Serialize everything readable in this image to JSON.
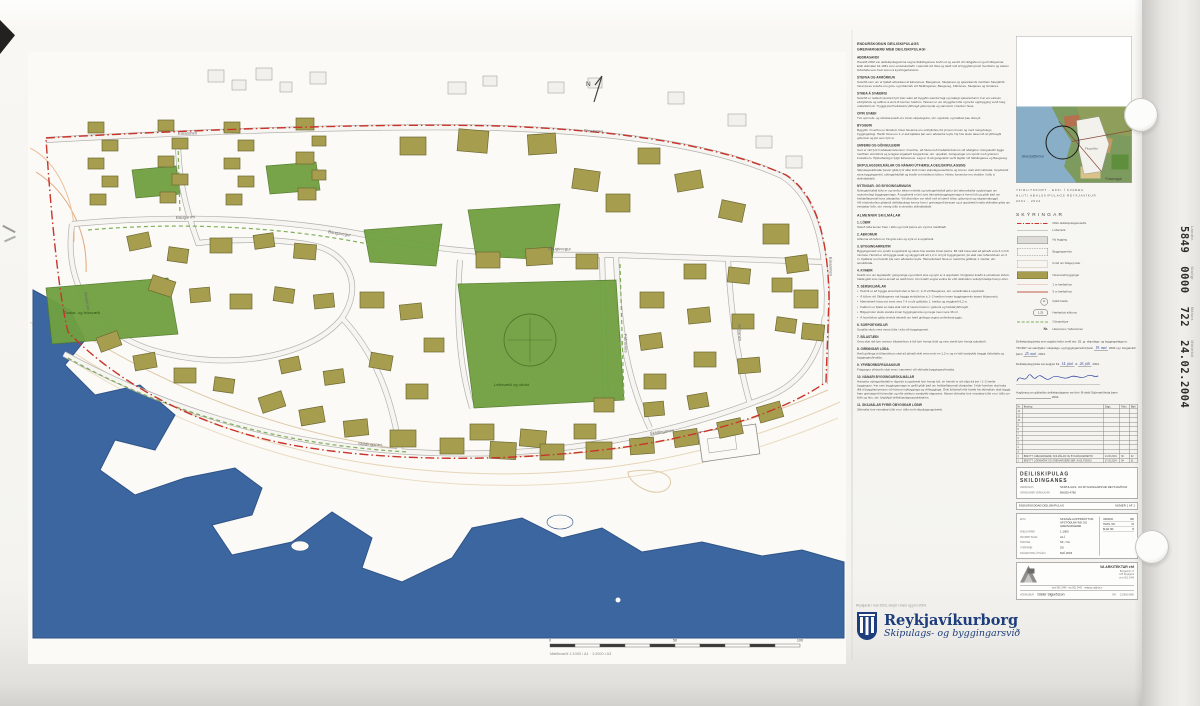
{
  "sheet": {
    "stamp": {
      "items": [
        {
          "label": "Landnr.",
          "value": "5849"
        },
        {
          "label": "Staðgr.",
          "value": "0000"
        },
        {
          "label": "Málsnr.",
          "value": "722"
        },
        {
          "label": "Móttekið",
          "value": "24.02.2004"
        }
      ]
    },
    "footer": {
      "pre": "Reykjavík í maí 2003, breytt í mars og júní 2004.",
      "name": "Reykjavíkurborg",
      "sub": "Skipulags- og byggingarsvið"
    }
  },
  "report": {
    "title": [
      "ENDURSKOÐUN DEILISKIPULAGS",
      "GREINARGERÐ MEÐ DEILISKIPULAGI"
    ],
    "sections": [
      {
        "h": "AÐDRAGANDI",
        "p": "Haustið 2002 var deiliskipulagsvinna vegna Skildinganess boðin út og samið við ráðgjafa um gerð tillögunnar. Eldri skilmálar frá 1981 voru endurskoðaðir í samráði við íbúa og tekið mið af byggðamynstri hverfisins og óskum lóðarhafa sem fram komu á kynningarfundum."
      },
      {
        "h": "STEFNA OG AFMÖRKUN",
        "p": "Svæðið sem um er fjallað afmarkast af Einarsnesi, Bauganesi, Skeljanesi og sjávarkambi meðfram Skerjafirði. Innan þess svæðis eru götu- og lóðamörk við Skildinganes, Baugsveg, Fáfnisnes, Skeljanes og Gnitanes."
      },
      {
        "h": "STAÐA Á SVÆÐINU",
        "p": "Svæðið er nokkuð sérstætt fyrir þær sakir að byggðin stendur lágt og nálægt sjávarsíðunni. Þar eru einkum einbýlishús og raðhús á einni til tveimur hæðum. Talsvert er um óbyggðar lóðir og hefur uppbygging verið hæg undanfarin ár. Tryggja þarf heildstætt yfirbragð götumynda og samræmi í hæðum húsa."
      },
      {
        "h": "OPIN SVÆÐI",
        "p": "Tvö opin leik- og útivistarsvæði eru innan skipulagsins, sbr. uppdrátt, og haldast þau óbreytt."
      },
      {
        "h": "BYGGÐIN",
        "p": "Byggðin í hverfinu er blönduð. Flest húsanna eru einbýlishús frá ýmsum tímum og með margvíslegu byggingarlagi. Hæðir húsa eru 1–2 auk kjallara þar sem aðstæður leyfa. Ný hús skulu taka mið af yfirbragði götunnar og því sem fyrir er."
      },
      {
        "h": "UMFERÐ OG GÖNGULEIÐIR",
        "p": "Gert er ráð fyrir hraðatakmörkunum í hverfinu, að hluta með hraðahindrunum við aðalgötur. Gönguleiðir liggja meðfram ströndinni og tengjast stígakerfi borgarinnar, sbr. uppdrátt. Göngustígar eru sýndir með grænum brotalínum. Hjólreiðastígur fylgir Einarsnesi. Lagt er til að gangstéttir verði lagðar við Skildinganes og Baugsveg."
      },
      {
        "h": "SKIPULAGSSKILMÁLAR OG NÁNARI ÚTFÆRSLA DEILISKIPULAGSINS",
        "p": "Skipulagsskilmálar þessir gilda fyrir allar lóðir innan skipulagssvæðisins og koma í stað eldri skilmála. Uppdrættir sýna byggingarreiti, nýtingarhlutfall og kvaðir á einstökum lóðum. Helstu forsendur eru skráðar í töflu á skilmálablaði."
      },
      {
        "h": "NÝTINGAR- OG BYGGINGARMAGN",
        "p": "Nýtingarhlutfall lóða er og verður áfram mishátt og nýtingarhlutfall gefur því takmarkaðar upplýsingar um raunverulegt byggingarmagn. Á uppdrætti er því sýnt hámarksbyggingarmagn á hverri lóð og gildir það um heildarflatarmál húss ofanjarðar. Við ákvörðun var tekið mið af stærð lóðar, götumynd og nágrannabyggð.\nVið endurskoðun gildandi deiliskipulags kemur fram í greinargerð þessari og á uppdrætti hvaða skilmálar gilda um einstakar lóðir, sbr. einnig töflu á sérstöku skilmálablaði."
      },
      {
        "h": "ALMENNIR SKILMÁLAR",
        "p": "",
        "major": true
      },
      {
        "h": "1. LÓÐIR",
        "p": "Stærð lóða kemur fram í töflu og mörk þeirra eru sýnd á mæliblaði."
      },
      {
        "h": "2. AÐKOMUR",
        "p": "Aðkoma að lóðum er frá götu eins og sýnt er á uppdrætti."
      },
      {
        "h": "3. BYGGINGARREITIR",
        "p": "Byggingarreitir eru sýndir á uppdrætti og skulu hús standa innan þeirra. Bil milli húsa skal að jafnaði vera 6 m hið minnsta. Heimilt er að byggja svalir og skyggni allt að 1,2 m út fyrir byggingarreit, þó ekki nær lóðamörkum en 3 m. Kjallarar eru heimilir þar sem aðstæður leyfa. Hámarkshæð húsa er mæld frá gólfkóta 1. hæðar, sbr. sérskilmála."
      },
      {
        "h": "4. KVAÐIR",
        "p": "Kvaðir eru um lagnaleiðir, göngustíga og umferð eins og sýnt er á uppdrætti. Þinglýstar kvaðir á einstökum lóðum halda gildi sínu nema annað sé tekið fram. Um kvaðir vegna veitna fer eftir skilmálum veitufyrirtækja hverju sinni."
      },
      {
        "h": "5. SÉRSKILMÁLAR",
        "p": "",
        "bullets": [
          "Heimilt er að byggja eina hæð ofan á hús nr. 2–8 við Bauganes, sbr. sérskilmála á uppdrætti.",
          "Á lóðum við Skildinganes má byggja einbýlishús á 1–2 hæðum innan byggingarreits ásamt bílgeymslu.",
          "Mænishæð húsa má mest vera 7,4 m yfir gólfplötu 1. hæðar og vegghæð 6,2 m.",
          "Þakform er frjálst en taka skal mið af næstu húsum í götunni og heildaryfirbragði.",
          "Bílgeymslur skulu standa innan byggingarreita og mega mest vera 36 m².",
          "Á hornlóðum gilda sérstök ákvæði um hæð girðinga vegna umferðaröryggis."
        ]
      },
      {
        "h": "6. SORPGEYMSLUR",
        "p": "Sorpílát skulu vera innan lóða í eða við byggingarreit."
      },
      {
        "h": "7. BÍLASTÆÐI",
        "p": "Gera skal ráð fyrir tveimur bílastæðum á lóð fyrir hverja íbúð og einu stæði fyrir hverja aukaíbúð."
      },
      {
        "h": "8. GIRÐINGAR LÓÐA",
        "p": "Hæð girðinga á lóðamörkum skal að jafnaði ekki vera meiri en 1,2 m og er háð samþykki beggja lóðarhafa og byggingaryfirvalda."
      },
      {
        "h": "9. YFIRBORÐSFRÁGANGUR",
        "p": "Frágangur yfirborðs skal vera í samræmi við skilmála byggingaryfirvalda."
      },
      {
        "h": "10. NÁNARI BYGGINGARSKILMÁLAR",
        "p": "Hámarks nýtingarhlutfall er tilgreint á uppdrætti fyrir hverja lóð, en heimilt er að víkja frá því í 1–2 hæða byggingum. Þar sem byggingarmagn er gefið gildir það um heildarflatarmál ofanjarðar. Í eldri hverfum skal taka tillit til byggðamynsturs við hönnun nýbygginga og viðbygginga. Óski lóðarhafi eftir fráviki frá skilmálum skal leggja fram greinargerð hönnuðar og eftir atvikum samþykki nágranna. Nánari skilmálar fyrir einstakar lóðir eru í töflu um lóðir og hús, sbr. fylgiskjal deiliskipulagsuppdráttarins."
      },
      {
        "h": "11. SKILMÁLAR FYRIR ÓBYGGÐAR LÓÐIR",
        "p": "Skilmálar fyrir einstakar lóðir eru í töflu með skipulagsuppdrætti."
      }
    ]
  },
  "inset": {
    "captions": [
      "YFIRLITSKORT - EKKI Í KVARÐA",
      "HLUTI AÐALSKIPULAGS REYKJAVÍKUR",
      "2001 - 2024"
    ],
    "sea_label": "Skerjafjörður",
    "bay_label": "Fossvogur",
    "area_label": "Flugvöllur"
  },
  "legend": {
    "title": "SKÝRINGAR",
    "items": [
      {
        "sym": "dashdot-red",
        "label": "Mörk deiliskipulagssvæðis"
      },
      {
        "sym": "line-gray",
        "label": "Lóðamörk"
      },
      {
        "sym": "rect-gray",
        "label": "Ný bygging"
      },
      {
        "sym": "rect-dash",
        "label": "Byggingarreitur"
      },
      {
        "sym": "rect-dot",
        "label": "Kvöð um bílageymslu"
      },
      {
        "sym": "rect-olive",
        "label": "Núverandi byggingar"
      },
      {
        "sym": "line-thinred",
        "label": "1 m hæðarlínur"
      },
      {
        "sym": "line-red",
        "label": "5 m hæðarlínur"
      },
      {
        "sym": "circle-h",
        "glyph": "H",
        "label": "Fjöldi hæða"
      },
      {
        "sym": "oval-k",
        "glyph": "1.23",
        "label": "Hæðarkóti aðkomu"
      },
      {
        "sym": "dash-green",
        "label": "Göngustígur"
      },
      {
        "sym": "text-nr",
        "glyph": "Nr.",
        "label": "Húsnúmer / lóðarnúmer"
      }
    ]
  },
  "approval": {
    "p1": [
      {
        "t": "Deiliskipulag þetta sem auglýst hefur verið skv. 25. gr. skipulags- og byggingarlaga nr. 73/1997 var samþykkt í skipulags- og byggingarnefnd þann "
      },
      {
        "hw": "19. maí"
      },
      {
        "t": " 2004 og í borgarráði þann "
      },
      {
        "hw": "25. maí"
      },
      {
        "t": " 2004."
      }
    ],
    "p2": [
      {
        "t": "Deiliskipulag þetta var auglýst frá "
      },
      {
        "hw": "14. júní"
      },
      {
        "t": " til "
      },
      {
        "hw": "26. júlí"
      },
      {
        "t": " 2004."
      }
    ],
    "p3": [
      {
        "t": "Auglýsing um gildistöku deiliskipulagsins var birt í B-deild Stjórnartíðinda þann "
      },
      {
        "blank": 70
      },
      {
        "t": " 2004."
      }
    ]
  },
  "revisions": {
    "headers": [
      "Nr.",
      "Breyting",
      "Dags.",
      "Teikn.",
      "Blað"
    ],
    "empty": [
      "12",
      "11",
      "10",
      "9",
      "8",
      "7",
      "6",
      "5",
      "4",
      "3"
    ],
    "filled": [
      {
        "no": "2",
        "text": "BREYTT: GREINARGERÐ, SKILMÁLAR OG BYGGINGARREITIR",
        "date": "24.06.2004",
        "init": "SÞ",
        "nr": "02"
      },
      {
        "no": "1",
        "text": "BREYTT: LÓÐAMÖRK OG GREINARGERÐ SBR. AUGLÝSINGU",
        "date": "07.05.2004",
        "init": "SÞ",
        "nr": "01"
      }
    ]
  },
  "titleblock": {
    "title1": "DEILISKIPULAG",
    "title2": "SKILDINGANES",
    "rows": [
      [
        "VERKKAUPI",
        "SKIPULAGS- OG BYGGINGARSVIÐ REYKJAVÍKUR"
      ],
      [
        "VERKNÚMER VERKKAUPA",
        "BN030-4780"
      ]
    ],
    "band_left": "ENDURSKOÐAÐ DEILISKIPULAG",
    "band_right": "NÚMER 1 AF 1",
    "info": [
      [
        "EFNI",
        "SKILMÁLAUPPDRÁTTUR, AFSTÖÐUMYND OG GREINARGERÐ"
      ],
      [
        "MÆLIKVARÐI",
        "1:1000"
      ],
      [
        "FRUMRIT BLAÐ",
        "A1-Í"
      ],
      [
        "TEIKNAÐ",
        "SÞ / VA"
      ],
      [
        "YFIRFARIÐ",
        "SS"
      ],
      [
        "DAGSETNING ÚTGÁFU",
        "MAÍ 2003"
      ]
    ],
    "mini": [
      [
        "VERKNR.",
        "380"
      ],
      [
        "TEIKN. NR.",
        "02"
      ],
      [
        "BLAÐ NR.",
        "B"
      ]
    ]
  },
  "firm": {
    "name": "VA ARKITEKTAR ehf",
    "addr": [
      "Borgartúni 17",
      "105 Reykjavík",
      "sími 561 2440"
    ],
    "contact": "sími 561 2440  ·  fax 561 2441  ·  netfang va@va.is",
    "credit_label": "HÖNNUÐUR",
    "credit": "Dieter Sigurðsson",
    "nr_label": "NR.",
    "nr": "123606-0890"
  },
  "map": {
    "north": "N",
    "park_labels_color": "#2f5512",
    "street_labels": [
      [
        "Einarsnes",
        150,
        83,
        -2
      ],
      [
        "Einarsnes",
        556,
        80,
        2
      ],
      [
        "Einarsnes",
        801,
        205,
        88
      ],
      [
        "Bauganes",
        148,
        167,
        -3
      ],
      [
        "Baugsvegur",
        300,
        181,
        9
      ],
      [
        "Baugsvegur",
        520,
        198,
        1
      ],
      [
        "Skildinganes",
        330,
        393,
        3
      ],
      [
        "Skildinganes",
        622,
        383,
        -8
      ],
      [
        "Fáfnisnes",
        596,
        282,
        88
      ],
      [
        "Gnitanes",
        710,
        272,
        87
      ],
      [
        "Skeljanes",
        56,
        240,
        80
      ]
    ],
    "greens": [
      {
        "pts": "430,232 588,228 596,348 446,356",
        "label": "Leiksvæði og útivist",
        "lx": 466,
        "ly": 334
      },
      {
        "pts": "18,236 140,226 150,282 24,292",
        "label": "Dvalar- og leiksvæði",
        "lx": 36,
        "ly": 262
      },
      {
        "pts": "104,118 148,114 152,142 108,146"
      },
      {
        "pts": "238,114 288,110 292,138 242,142"
      },
      {
        "pts": "440,158 532,152 524,208 448,204"
      },
      {
        "pts": "336,178 414,172 408,214 342,210"
      }
    ],
    "buildings": [
      [
        60,
        70,
        16,
        11,
        0
      ],
      [
        74,
        88,
        16,
        11,
        0
      ],
      [
        60,
        106,
        16,
        11,
        0
      ],
      [
        74,
        124,
        16,
        11,
        0
      ],
      [
        62,
        142,
        16,
        11,
        0
      ],
      [
        130,
        68,
        16,
        11,
        0
      ],
      [
        144,
        86,
        16,
        11,
        0
      ],
      [
        130,
        104,
        16,
        11,
        0
      ],
      [
        144,
        122,
        16,
        11,
        0
      ],
      [
        132,
        140,
        16,
        11,
        0
      ],
      [
        196,
        70,
        16,
        11,
        0
      ],
      [
        210,
        88,
        16,
        11,
        0
      ],
      [
        196,
        106,
        16,
        11,
        0
      ],
      [
        210,
        124,
        16,
        11,
        0
      ],
      [
        198,
        142,
        16,
        11,
        0
      ],
      [
        268,
        66,
        18,
        12,
        0
      ],
      [
        284,
        84,
        14,
        10,
        0
      ],
      [
        268,
        100,
        18,
        12,
        0
      ],
      [
        284,
        118,
        14,
        10,
        0
      ],
      [
        270,
        136,
        18,
        12,
        0
      ],
      [
        372,
        85,
        26,
        18,
        0
      ],
      [
        430,
        78,
        30,
        22,
        5
      ],
      [
        500,
        82,
        28,
        20,
        -4
      ],
      [
        545,
        118,
        26,
        20,
        8
      ],
      [
        578,
        142,
        24,
        18,
        0
      ],
      [
        610,
        96,
        22,
        16,
        0
      ],
      [
        648,
        120,
        26,
        18,
        -10
      ],
      [
        692,
        150,
        24,
        18,
        12
      ],
      [
        735,
        172,
        26,
        20,
        0
      ],
      [
        758,
        204,
        22,
        16,
        -8
      ],
      [
        766,
        238,
        24,
        18,
        0
      ],
      [
        774,
        272,
        22,
        16,
        6
      ],
      [
        100,
        182,
        22,
        15,
        -12
      ],
      [
        140,
        196,
        20,
        14,
        8
      ],
      [
        182,
        186,
        22,
        15,
        0
      ],
      [
        226,
        182,
        20,
        14,
        -8
      ],
      [
        266,
        192,
        22,
        15,
        5
      ],
      [
        122,
        226,
        24,
        16,
        18
      ],
      [
        162,
        236,
        20,
        14,
        -5
      ],
      [
        202,
        242,
        22,
        15,
        0
      ],
      [
        246,
        236,
        20,
        14,
        8
      ],
      [
        286,
        242,
        20,
        14,
        -6
      ],
      [
        70,
        282,
        22,
        15,
        -20
      ],
      [
        106,
        302,
        22,
        15,
        -10
      ],
      [
        146,
        316,
        22,
        15,
        0
      ],
      [
        186,
        326,
        20,
        14,
        8
      ],
      [
        332,
        240,
        24,
        16,
        0
      ],
      [
        372,
        252,
        22,
        15,
        -6
      ],
      [
        396,
        286,
        20,
        14,
        0
      ],
      [
        342,
        302,
        22,
        15,
        10
      ],
      [
        378,
        332,
        22,
        15,
        0
      ],
      [
        448,
        200,
        24,
        16,
        0
      ],
      [
        498,
        196,
        26,
        17,
        -4
      ],
      [
        548,
        202,
        22,
        15,
        0
      ],
      [
        612,
        240,
        24,
        16,
        0
      ],
      [
        612,
        282,
        22,
        15,
        -8
      ],
      [
        616,
        322,
        22,
        15,
        0
      ],
      [
        442,
        372,
        24,
        16,
        0
      ],
      [
        492,
        378,
        26,
        17,
        5
      ],
      [
        546,
        372,
        22,
        15,
        0
      ],
      [
        232,
        342,
        24,
        16,
        -18
      ],
      [
        272,
        356,
        24,
        16,
        -10
      ],
      [
        316,
        368,
        24,
        16,
        -6
      ],
      [
        362,
        378,
        26,
        17,
        0
      ],
      [
        412,
        386,
        24,
        16,
        0
      ],
      [
        462,
        390,
        26,
        17,
        3
      ],
      [
        512,
        392,
        24,
        16,
        0
      ],
      [
        558,
        390,
        26,
        17,
        0
      ],
      [
        602,
        386,
        24,
        16,
        -4
      ],
      [
        646,
        378,
        24,
        16,
        -8
      ],
      [
        690,
        368,
        24,
        16,
        -12
      ],
      [
        730,
        352,
        24,
        16,
        -16
      ],
      [
        252,
        306,
        20,
        14,
        -12
      ],
      [
        296,
        318,
        20,
        14,
        -8
      ],
      [
        566,
        346,
        20,
        14,
        0
      ],
      [
        616,
        350,
        20,
        14,
        -5
      ],
      [
        660,
        342,
        20,
        14,
        -10
      ],
      [
        656,
        212,
        22,
        15,
        0
      ],
      [
        700,
        216,
        22,
        15,
        6
      ],
      [
        744,
        226,
        20,
        14,
        0
      ],
      [
        660,
        256,
        22,
        15,
        -6
      ],
      [
        704,
        262,
        22,
        15,
        0
      ],
      [
        748,
        266,
        20,
        14,
        8
      ],
      [
        666,
        300,
        22,
        15,
        0
      ],
      [
        710,
        306,
        22,
        15,
        -5
      ]
    ],
    "context": [
      [
        180,
        18,
        16,
        12
      ],
      [
        204,
        28,
        14,
        10
      ],
      [
        228,
        16,
        16,
        12
      ],
      [
        252,
        30,
        12,
        10
      ],
      [
        282,
        20,
        16,
        12
      ],
      [
        420,
        30,
        18,
        12
      ],
      [
        455,
        24,
        14,
        10
      ],
      [
        520,
        30,
        16,
        11
      ],
      [
        560,
        26,
        14,
        10
      ],
      [
        640,
        40,
        16,
        12
      ],
      [
        700,
        62,
        18,
        12
      ],
      [
        728,
        84,
        16,
        12
      ],
      [
        758,
        104,
        16,
        12
      ]
    ],
    "scalebar": {
      "labels": [
        [
          "0",
          0
        ],
        [
          "50",
          125
        ],
        [
          "100",
          250
        ]
      ],
      "caption": "Mælikvarði 1:1000 í A1  ·  1:2000 í A3"
    }
  }
}
